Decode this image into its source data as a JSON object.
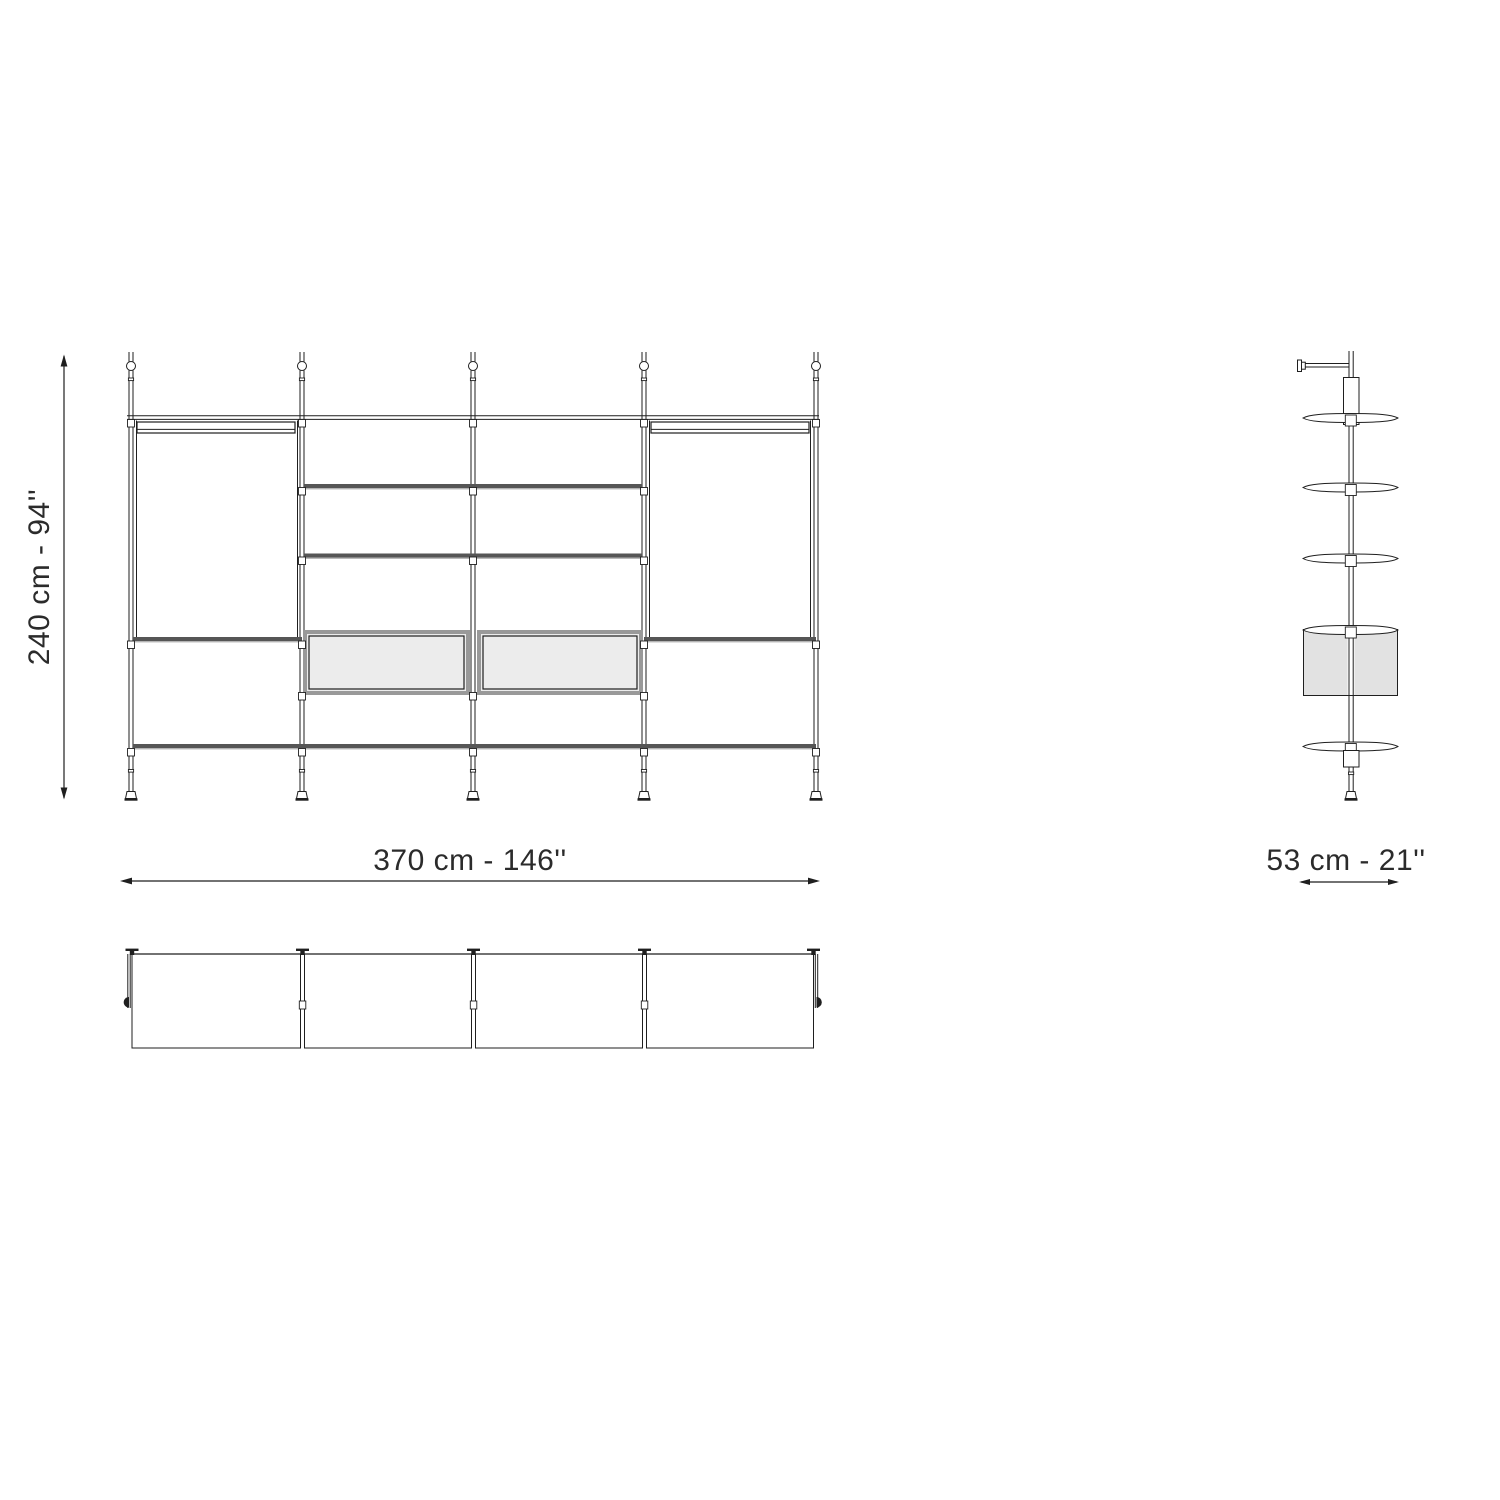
{
  "drawing": {
    "type": "furniture-technical-drawing",
    "views": {
      "front": "front elevation",
      "side": "side elevation",
      "plan": "top plan"
    }
  },
  "dimensions": {
    "height_label": "240 cm - 94''",
    "width_label": "370 cm - 146''",
    "depth_label": "53 cm - 21''"
  },
  "colors": {
    "bg": "#ffffff",
    "line": "#1f1f1f",
    "shelf": "#565656",
    "shelf-light": "#b3b3b3",
    "cab-fill": "#ececec",
    "cab-frame": "#999999",
    "side-fill": "#e2e2e2",
    "text": "#2b2b2b"
  }
}
